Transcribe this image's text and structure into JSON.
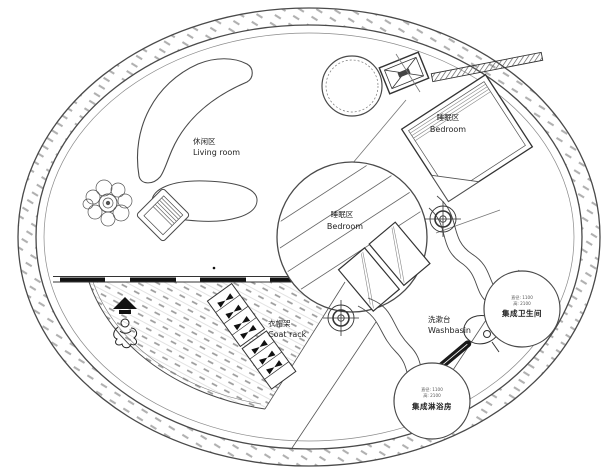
{
  "plan": {
    "title": "Circular tiny-house floor plan",
    "areas": {
      "living_room": {
        "zh": "休闲区",
        "en": "Living room"
      },
      "bedroom_upper": {
        "zh": "睡眠区",
        "en": "Bedroom"
      },
      "bedroom_center": {
        "zh": "睡眠区",
        "en": "Bedroom"
      },
      "coat_rack": {
        "zh": "衣帽架",
        "en": "Coat rack"
      },
      "washbasin": {
        "zh": "洗漱台",
        "en": "Washbasin"
      },
      "bathroom_pod": {
        "name": "集成卫生间",
        "dims_line1": "直径: 1100",
        "dims_line2": "高: 2100"
      },
      "shower_pod": {
        "name": "集成淋浴房",
        "dims_line1": "直径: 1100",
        "dims_line2": "高: 2100"
      }
    },
    "colors": {
      "line": "#4a4a4a",
      "hatch": "#aaaaaa",
      "text": "#222222",
      "fill": "#ffffff"
    }
  }
}
